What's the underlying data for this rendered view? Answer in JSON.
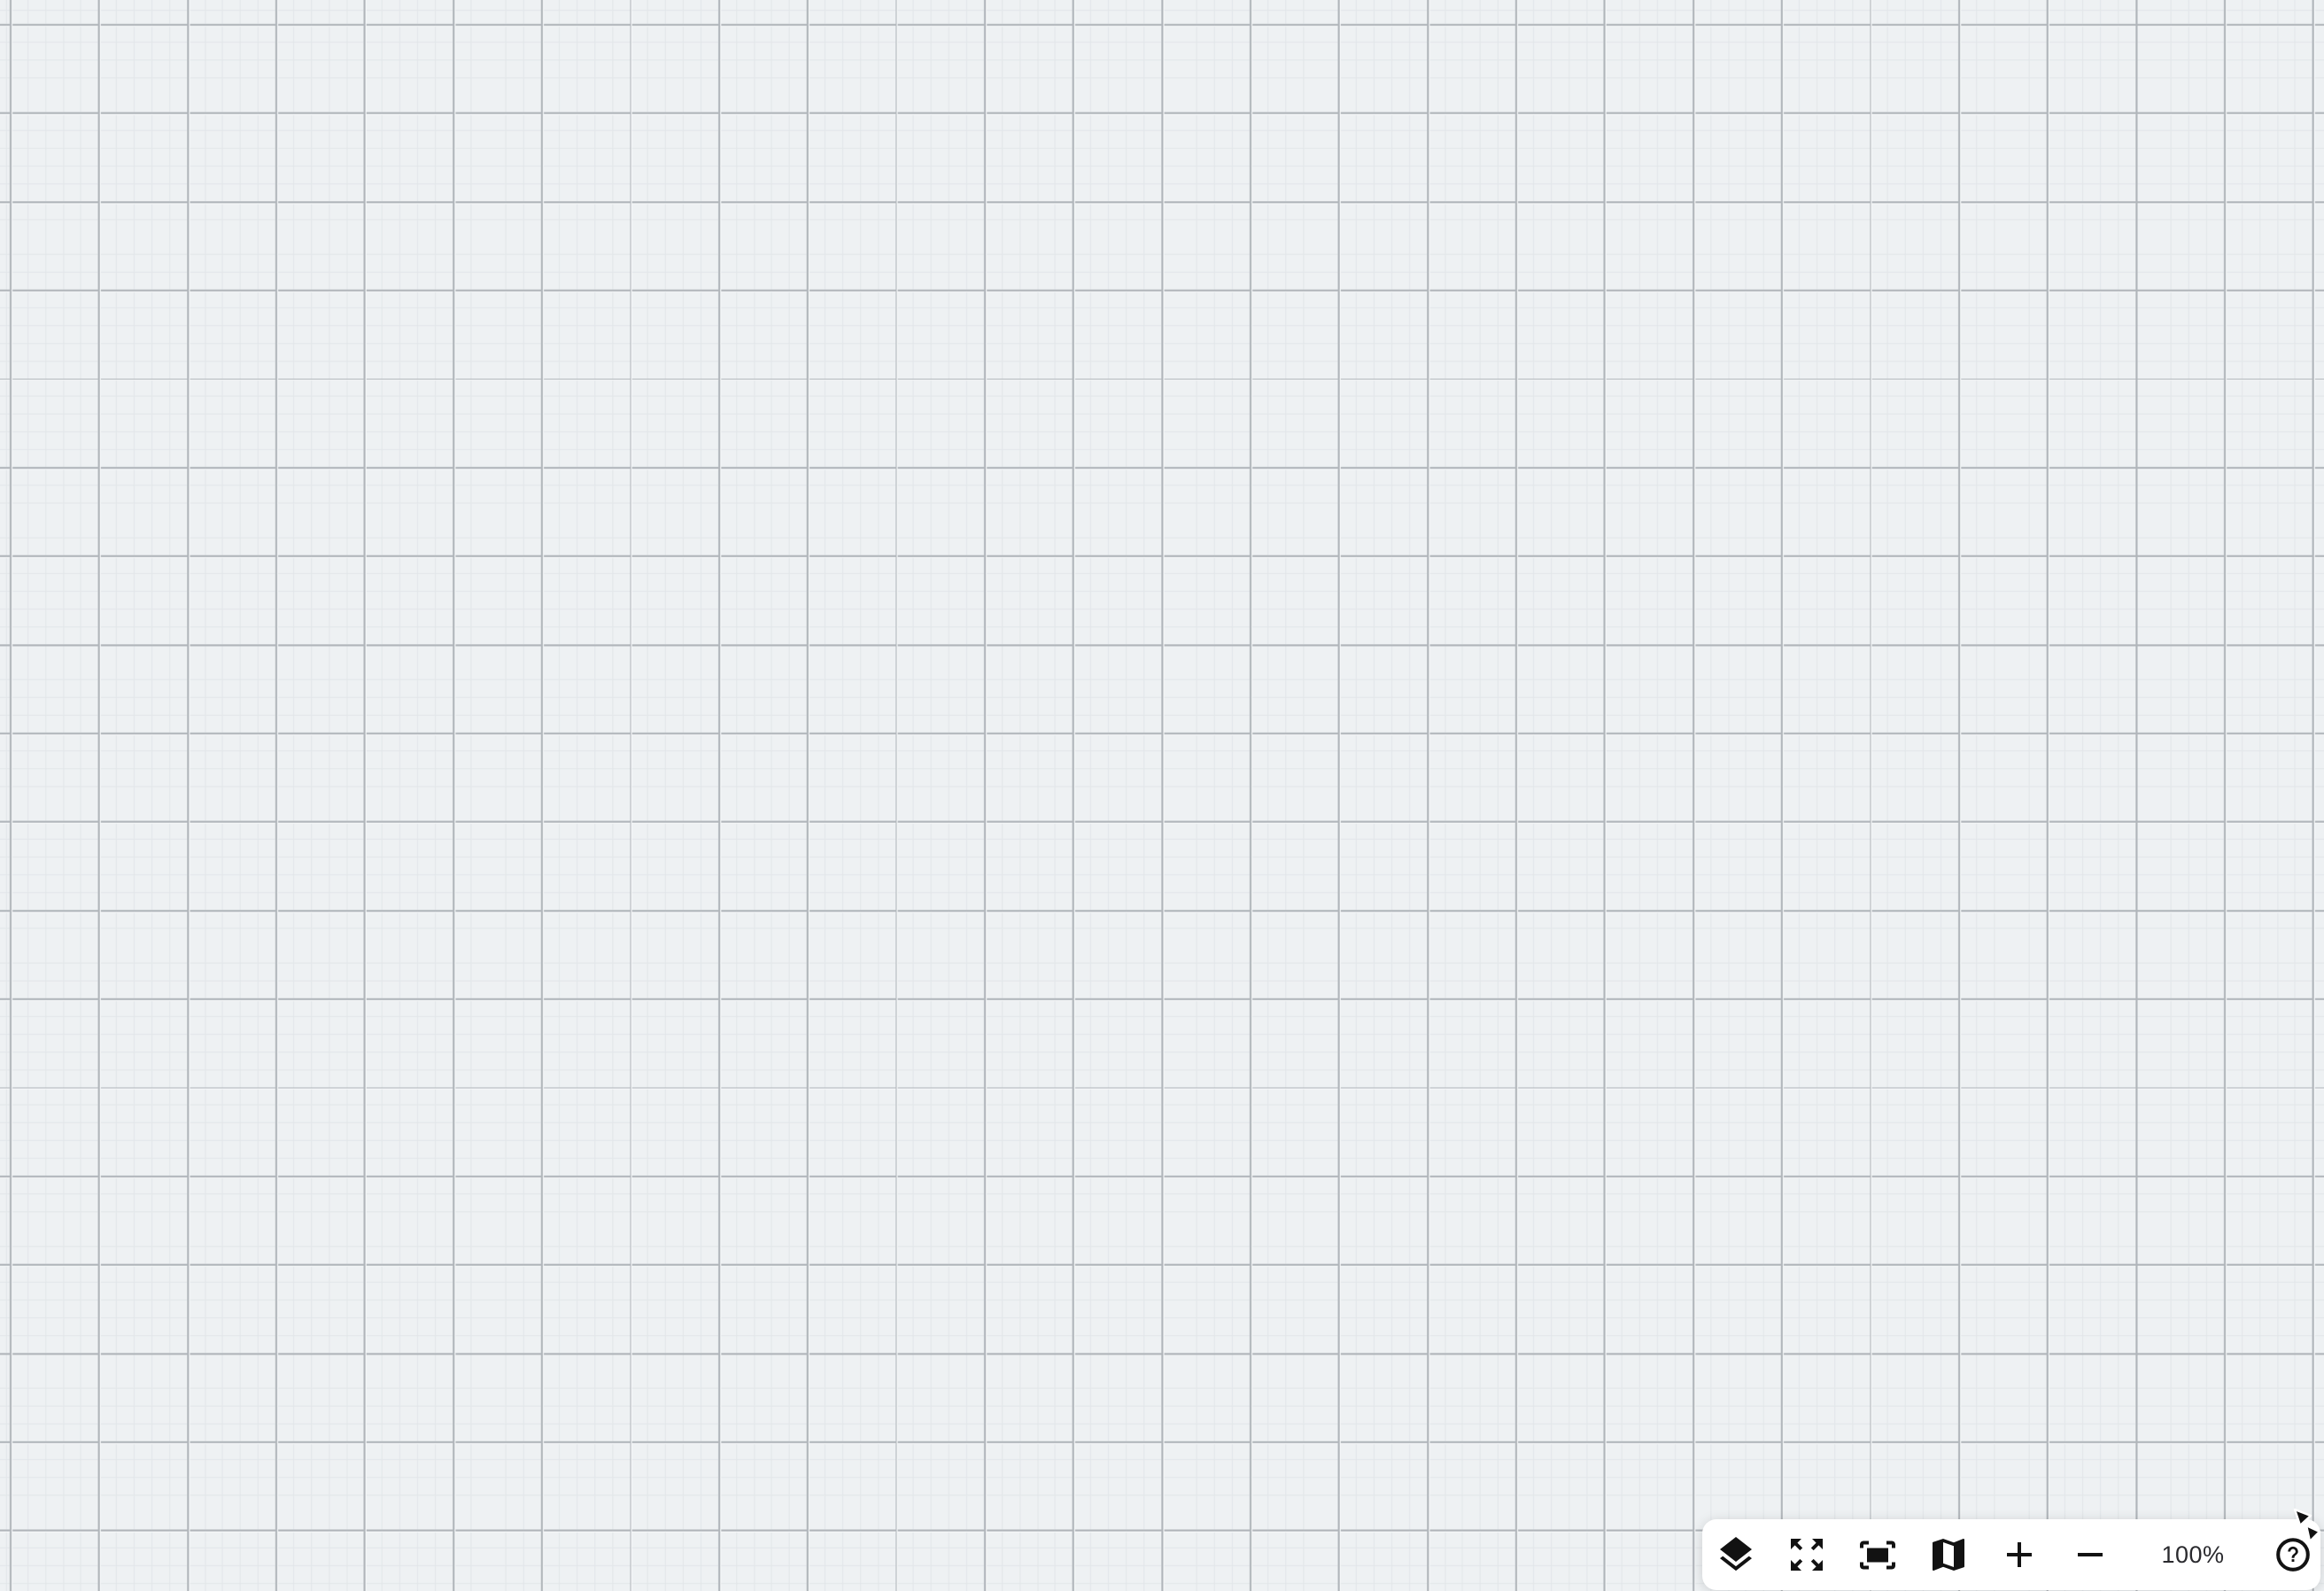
{
  "canvas": {
    "background_color": "#eef1f3",
    "grid": {
      "minor_spacing_px": 20,
      "major_spacing_px": 100,
      "minor_line_color": "#e2e6e9",
      "major_line_color": "#b0b5ba",
      "emboss_highlight_color": "#f7f9fa"
    }
  },
  "zoom_toolbar": {
    "background_color": "#ffffff",
    "icon_color": "#121212",
    "zoom_level": "100%",
    "items": [
      {
        "name": "layers",
        "icon": "layers-icon"
      },
      {
        "name": "expand-view",
        "icon": "expand-arrows-icon"
      },
      {
        "name": "zoom-to-fit",
        "icon": "fit-screen-icon"
      },
      {
        "name": "minimap",
        "icon": "map-icon"
      },
      {
        "name": "zoom-in",
        "icon": "plus-icon"
      },
      {
        "name": "zoom-out",
        "icon": "minus-icon"
      },
      {
        "name": "zoom-level",
        "label": "100%"
      },
      {
        "name": "help",
        "icon": "question-circle-icon"
      }
    ]
  },
  "cursor": {
    "shape": "arrow-pointer",
    "color": "#111111"
  }
}
